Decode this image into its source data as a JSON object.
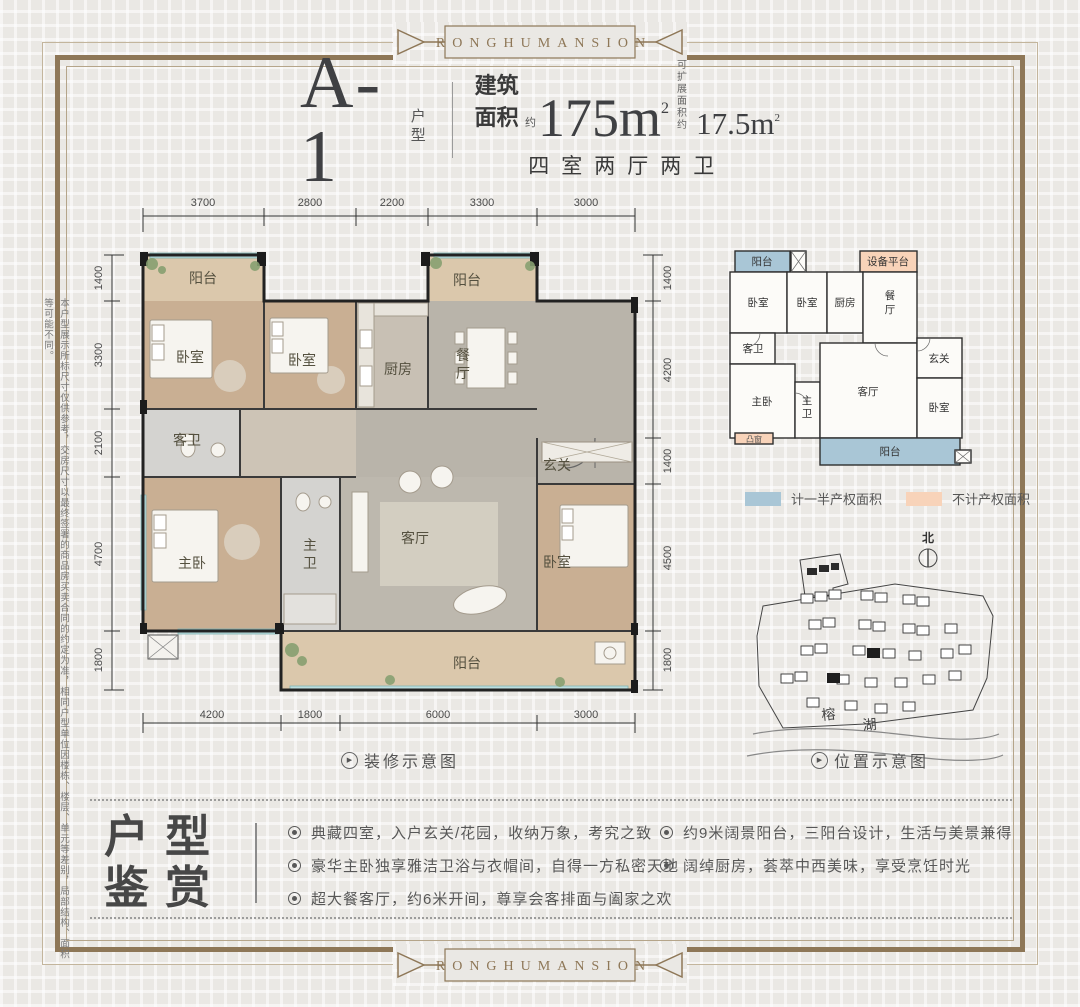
{
  "brand": {
    "band": "RONGHUMANSION"
  },
  "icons": {
    "caption_marker": "▶",
    "bullet": "◉"
  },
  "colors": {
    "frame": "#8e7757",
    "half_area": "#a9c6d6",
    "no_area": "#f8d3b9",
    "wall": "#2a2a2a"
  },
  "header": {
    "unit": "A-1",
    "unit_suffix": "户型",
    "area_label": "建筑面积",
    "area_approx": "约",
    "area_value": "175m",
    "area_sup": "2",
    "ext_line1": "可扩展",
    "ext_line2": "面积约",
    "ext_value": "17.5m",
    "ext_sup": "2",
    "layout": "四室两厅两卫"
  },
  "floorplan": {
    "dims_top": [
      "3700",
      "2800",
      "2200",
      "3300",
      "3000"
    ],
    "dims_left": [
      "1400",
      "3300",
      "2100",
      "4700",
      "1800"
    ],
    "dims_right": [
      "1400",
      "4200",
      "1400",
      "4500",
      "1800"
    ],
    "dims_bottom": [
      "4200",
      "1800",
      "6000",
      "3000"
    ],
    "rooms": {
      "balcony_tl": "阳台",
      "bedroom_a": "卧室",
      "bedroom_b": "卧室",
      "kitchen": "厨房",
      "dining": "餐厅",
      "balcony_tr": "阳台",
      "guest_bath": "客卫",
      "foyer": "玄关",
      "master": "主卧",
      "master_bath": "主卫",
      "living": "客厅",
      "bedroom_c": "卧室",
      "balcony_b": "阳台"
    },
    "caption": "装修示意图"
  },
  "schematic": {
    "rooms": {
      "balcony_top": "阳台",
      "equipment": "设备平台",
      "bedroom_a": "卧室",
      "bedroom_b": "卧室",
      "kitchen": "厨房",
      "dining": "餐厅",
      "guest_bath": "客卫",
      "foyer": "玄关",
      "master": "主卧",
      "master_bath": "主卫",
      "living": "客厅",
      "bedroom_c": "卧室",
      "bay_window": "凸窗",
      "balcony_bottom": "阳台"
    },
    "legend": [
      {
        "label": "计一半产权面积",
        "color": "#a9c6d6"
      },
      {
        "label": "不计产权面积",
        "color": "#f8d3b9"
      }
    ]
  },
  "sitemap": {
    "north": "北",
    "lake": "榕湖",
    "caption": "位置示意图"
  },
  "features": {
    "title_line1": "户型",
    "title_line2": "鉴赏",
    "items_left": [
      "典藏四室，入户玄关/花园，收纳万象，考究之致",
      "豪华主卧独享雅洁卫浴与衣帽间，自得一方私密天地",
      "超大餐客厅，约6米开间，尊享会客排面与阖家之欢"
    ],
    "items_right": [
      "约9米阔景阳台，三阳台设计，生活与美景兼得",
      "阔绰厨房，荟萃中西美味，享受烹饪时光"
    ]
  },
  "disclaimer": "本户型展示所标尺寸仅供参考，交房尺寸以最终签署的商品房买卖合同的约定为准，相同户型单位因楼栋、楼层、单元等差别，局部结构、面积等可能不同。"
}
